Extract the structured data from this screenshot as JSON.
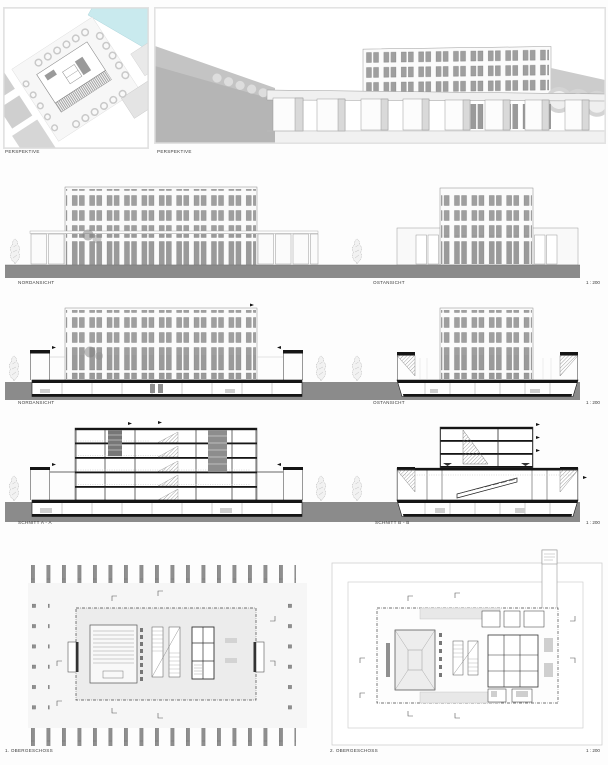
{
  "board_title": "architecture-presentation-board",
  "colors": {
    "ground_band": "#8b8b8b",
    "water": "#c9eaee",
    "glass": "#9f9f9f",
    "section_ink": "#151515",
    "paper": "#fdfdfd"
  },
  "panels": {
    "aerial": {
      "label": "PERSPEKTIVE"
    },
    "street": {
      "label": "PERSPEKTIVE"
    },
    "elev_north": {
      "label": "NORDANSICHT"
    },
    "elev_east": {
      "label": "OSTANSICHT",
      "scale": "1 : 200"
    },
    "cut_north": {
      "label": "NORDANSICHT"
    },
    "cut_east": {
      "label": "OSTANSICHT",
      "scale": "1 : 200"
    },
    "section_a": {
      "label": "SCHNITT A - A"
    },
    "section_b": {
      "label": "SCHNITT B - B",
      "scale": "1 : 200"
    },
    "plan1": {
      "label": "1. OBERGESCHOSS"
    },
    "plan2": {
      "label": "2. OBERGESCHOSS",
      "scale": "1 : 200"
    }
  }
}
